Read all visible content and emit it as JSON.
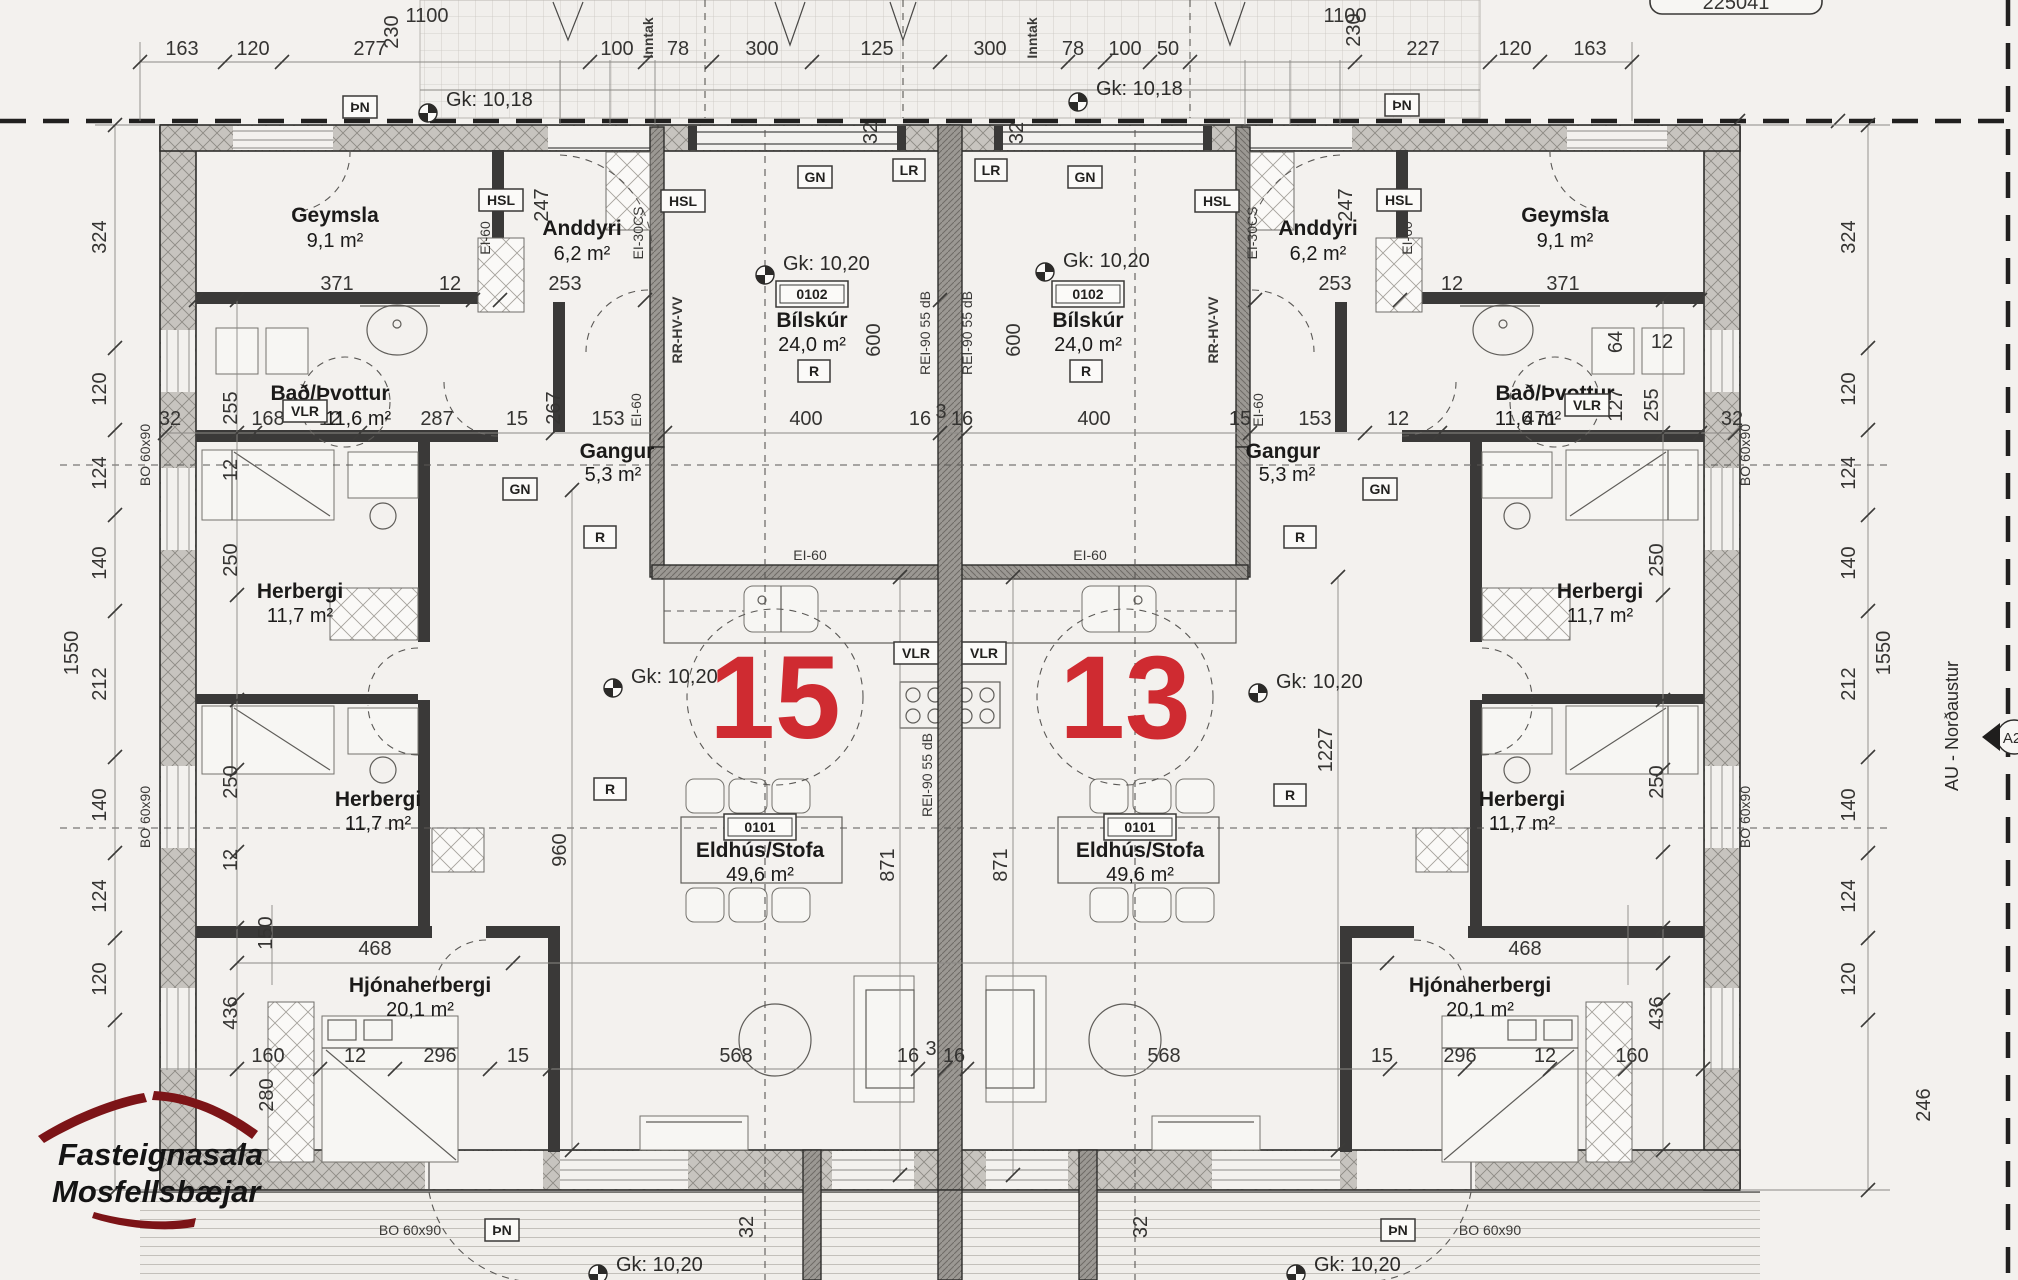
{
  "sheet": {
    "number": "225041"
  },
  "units": {
    "left": "15",
    "right": "13"
  },
  "rooms": {
    "geymsla": {
      "name": "Geymsla",
      "area": "9,1 m²"
    },
    "anddyri": {
      "name": "Anddyri",
      "area": "6,2 m²"
    },
    "bilskur": {
      "id": "0102",
      "name": "Bílskúr",
      "area": "24,0 m²"
    },
    "bad": {
      "name": "Bað/Þvottur",
      "area": "11,6 m²"
    },
    "gangur": {
      "name": "Gangur",
      "area": "5,3 m²"
    },
    "herbergi": {
      "name": "Herbergi",
      "area": "11,7 m²"
    },
    "eldhus": {
      "id": "0101",
      "name": "Eldhús/Stofa",
      "area": "49,6 m²"
    },
    "hjonaherbergi": {
      "name": "Hjónaherbergi",
      "area": "20,1 m²"
    }
  },
  "codes": {
    "pn": "ÞN",
    "hsl": "HSL",
    "vlr": "VLR",
    "gn": "GN",
    "lr": "LR",
    "r": "R",
    "ei60": "EI-60",
    "ei30cs": "EI-30CS",
    "rrhvvv": "RR-HV-VV",
    "rei90": "REI-90 55 dB",
    "bo": "BO 60x90",
    "inntak": "Inntak"
  },
  "levels": {
    "gk1018": "Gk: 10,18",
    "gk1020": "Gk: 10,20"
  },
  "logo": {
    "line1": "Fasteignasala",
    "line2": "Mosfellsbæjar"
  },
  "compass": {
    "label": "AU - Norðaustur",
    "section": "A2"
  },
  "dims": [
    "163",
    "120",
    "277",
    "100",
    "78",
    "300",
    "125",
    "300",
    "78",
    "100",
    "50",
    "227",
    "120",
    "163",
    "1100",
    "1100",
    "230",
    "230",
    "324",
    "120",
    "124",
    "140",
    "212",
    "140",
    "124",
    "120",
    "1550",
    "324",
    "120",
    "124",
    "140",
    "212",
    "140",
    "124",
    "120",
    "1550",
    "246",
    "371",
    "12",
    "253",
    "253",
    "12",
    "371",
    "32",
    "168",
    "12",
    "287",
    "15",
    "153",
    "400",
    "16",
    "3",
    "16",
    "400",
    "15",
    "153",
    "12",
    "471",
    "32",
    "255",
    "267",
    "247",
    "247",
    "255",
    "127",
    "64",
    "12",
    "600",
    "600",
    "960",
    "1227",
    "871",
    "871",
    "250",
    "250",
    "12",
    "12",
    "250",
    "250",
    "150",
    "436",
    "436",
    "468",
    "468",
    "160",
    "12",
    "296",
    "15",
    "568",
    "16",
    "3",
    "16",
    "568",
    "15",
    "296",
    "12",
    "160",
    "32",
    "32",
    "32",
    "32",
    "280"
  ]
}
